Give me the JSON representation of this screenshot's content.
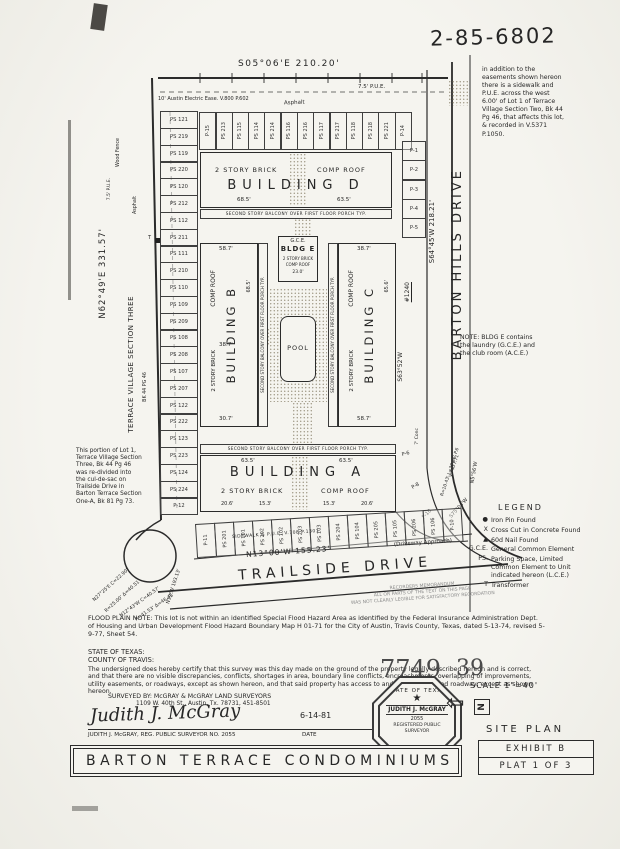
{
  "page": {
    "doc_number": "2-85-6802",
    "easement_note": "in addition to the easements shown hereon there is a sidewalk and P.U.E. across the west 6.00' of Lot 1 of Terrace Village Section Two, Bk 44 Pg 46, that affects this lot, & recorded in V.5371 P.1050."
  },
  "bearings": {
    "north": "S05°06'E  210.20'",
    "west": "N62°49'E  331.57'",
    "east": "S64°45'W  218.21'",
    "south": "N13°00'W  155.23'"
  },
  "streets": {
    "barton": "BARTON HILLS DRIVE",
    "trailside": "TRAILSIDE DRIVE",
    "driveway": "(Driveway Approach)",
    "sidewalk": "SIDEWALK & P.U.E. V.708 P.1301"
  },
  "site": {
    "pue_top": "7.5' P.U.E.",
    "pue_left": "7.5' P.U.E.",
    "electric": "10' Austin Electric Ease. V.800 P.602",
    "asphalt_top": "Asphalt",
    "asphalt_left": "Asphalt",
    "wood_fence": "Wood Fence",
    "terrace": "TERRACE VILLAGE SECTION THREE",
    "record": "BK 44 PG 46",
    "address": "#1240",
    "transformer": "T"
  },
  "notes": {
    "portion": "This portion of Lot 1, Terrace Village Section Three, Bk 44 Pg 46 was re-divided into the cul-de-sac on Trailside Drive in Barton Terrace Section One-A, Bk 81 Pg 73.",
    "bldg_e": "NOTE: BLDG E contains the laundry (G.C.E.) and the club room (A.C.E.)",
    "flood": "FLOOD PLAIN NOTE: This lot is not within an identified Special Flood Hazard Area as identified by the Federal Insurance Administration Dept. of Housing and Urban Development Flood Hazard Boundary Map H 01-71 for the City of Austin, Travis County, Texas, dated 5-13-74, revised 5-9-77, Sheet 54.",
    "memo1": "RECORDERS MEMORANDUM",
    "memo2": "ALL OR PARTS OF THE TEXT ON THIS PAGE",
    "memo3": "WAS NOT CLEARLY LEGIBLE FOR SATISFACTORY RECORDATION"
  },
  "curves": {
    "sw": [
      "N27°25'E C=22.90'",
      "R=25.00' Δ=40.51'",
      "N12°43'W C=40.57'",
      "R=41.53' Δ=46.45'",
      "N19°W 193.13'"
    ],
    "se": [
      "S63°52'W",
      "R=766.56' C=29.79'",
      "R=10.43' L=30.46' P.6",
      "V.740 P.71",
      "S75°04'W",
      "N5°56'W",
      "7' Conc"
    ],
    "lower_stalls": [
      "P-6",
      "P-8",
      "P-10"
    ]
  },
  "buildings": {
    "d": {
      "name": "BUILDING  D",
      "mat": "2 STORY BRICK",
      "roof": "COMP ROOF",
      "dim_left": "68.5'",
      "dim_right": "63.5'",
      "balcony": "SECOND STORY BALCONY OVER FIRST FLOOR PORCH TYP."
    },
    "b": {
      "name": "BUILDING B",
      "mat": "2 STORY BRICK",
      "roof": "COMP ROOF",
      "dim_top": "58.7'",
      "dim_mid": "38.7'",
      "dim_bottom": "30.7'",
      "dim_side": "68.5'",
      "balcony": "SECOND STORY BALCONY OVER FIRST FLOOR PORCH TYP."
    },
    "c": {
      "name": "BUILDING C",
      "mat": "2 STORY BRICK",
      "roof": "COMP ROOF",
      "dim_top": "38.7'",
      "dim_bottom": "58.7'",
      "dim_side": "65.6'",
      "balcony": "SECOND STORY BALCONY OVER FIRST FLOOR PORCH TYP."
    },
    "a": {
      "name": "BUILDING  A",
      "mat": "2 STORY BRICK",
      "roof": "COMP ROOF",
      "dim_left": "63.5'",
      "dim_right": "63.5'",
      "dims_bottom": [
        "20.6'",
        "15.3'",
        "15.3'",
        "20.6'"
      ],
      "balcony": "SECOND STORY BALCONY OVER FIRST FLOOR PORCH TYP."
    },
    "e": {
      "gce": "G.C.E.",
      "name": "BLDG E",
      "mat": "2 STORY BRICK",
      "roof": "COMP ROOF",
      "dim": "23.0'"
    },
    "pool": "POOL"
  },
  "parking": {
    "top": [
      "P-15",
      "PS 213",
      "PS 115",
      "PS 114",
      "PS 214",
      "PS 116",
      "PS 216",
      "PS 117",
      "PS 217",
      "PS 118",
      "PS 218",
      "PS 221",
      "P-14"
    ],
    "left": [
      "PS 121",
      "PS 219",
      "PS 119",
      "PS 220",
      "PS 120",
      "PS 212",
      "PS 112",
      "PS 211",
      "PS 111",
      "PS 210",
      "PS 110",
      "PS 109",
      "PS 209",
      "PS 108",
      "PS 208",
      "PS 107",
      "PS 207",
      "PS 122",
      "PS 222",
      "PS 123",
      "PS 223",
      "PS 124",
      "PS 224",
      "P-12"
    ],
    "right": [
      "P-1",
      "P-2",
      "P-3",
      "P-4",
      "P-5"
    ],
    "bottom": [
      "P-11",
      "PS 201",
      "PS 101",
      "PS 202",
      "PS 102",
      "PS 203",
      "PS 103",
      "PS 204",
      "PS 104",
      "PS 205",
      "PS 105",
      "PS 206",
      "PS 106",
      "P-10"
    ]
  },
  "legend": {
    "title": "LEGEND",
    "items": [
      {
        "s": "●",
        "t": "Iron Pin Found"
      },
      {
        "s": "X",
        "t": "Cross Cut in Concrete Found"
      },
      {
        "s": "▲",
        "t": "60d Nail Found"
      },
      {
        "s": "G.C.E.",
        "t": "General Common Element"
      },
      {
        "s": "PS.",
        "t": "Parking Space, Limited Common Element to Unit indicated hereon (L.C.E.)"
      },
      {
        "s": "T",
        "t": "Transformer"
      }
    ]
  },
  "cert": {
    "state": "STATE OF TEXAS:",
    "county": "COUNTY OF TRAVIS:",
    "body": "The undersigned does hereby certify that this survey was this day made on the ground of the property legally described hereon and is correct, and that there are no visible discrepancies, conflicts, shortages in area, boundary line conflicts, encroachments, overlapping of improvements, utility easements, or roadways, except as shown hereon, and that said property has access to and from a dedicated roadway, except as shown hereon.",
    "surveyed_by": "SURVEYED BY: McGRAY & McGRAY LAND SURVEYORS",
    "address": "1109 W. 40th St., Austin, Tx. 78731, 451-8501"
  },
  "stamp": {
    "left": "7749",
    "dots": "..",
    "right": "39"
  },
  "signature": {
    "script": "Judith J. McGray",
    "date": "6-14-81",
    "caption": "JUDITH J. McGRAY, REG. PUBLIC SURVEYOR NO. 2055",
    "date_label": "DATE"
  },
  "seal": {
    "top": "STATE OF TEXAS",
    "star": "★",
    "name": "JUDITH J. McGRAY",
    "number": "2055",
    "bottom": "REGISTERED PUBLIC SURVEYOR"
  },
  "footer": {
    "scale": "SCALE 1\"=40'",
    "north": "N",
    "site_plan": "SITE PLAN",
    "exhibit": "EXHIBIT B",
    "plat": "PLAT 1 OF 3",
    "title": "BARTON TERRACE CONDOMINIUMS"
  }
}
